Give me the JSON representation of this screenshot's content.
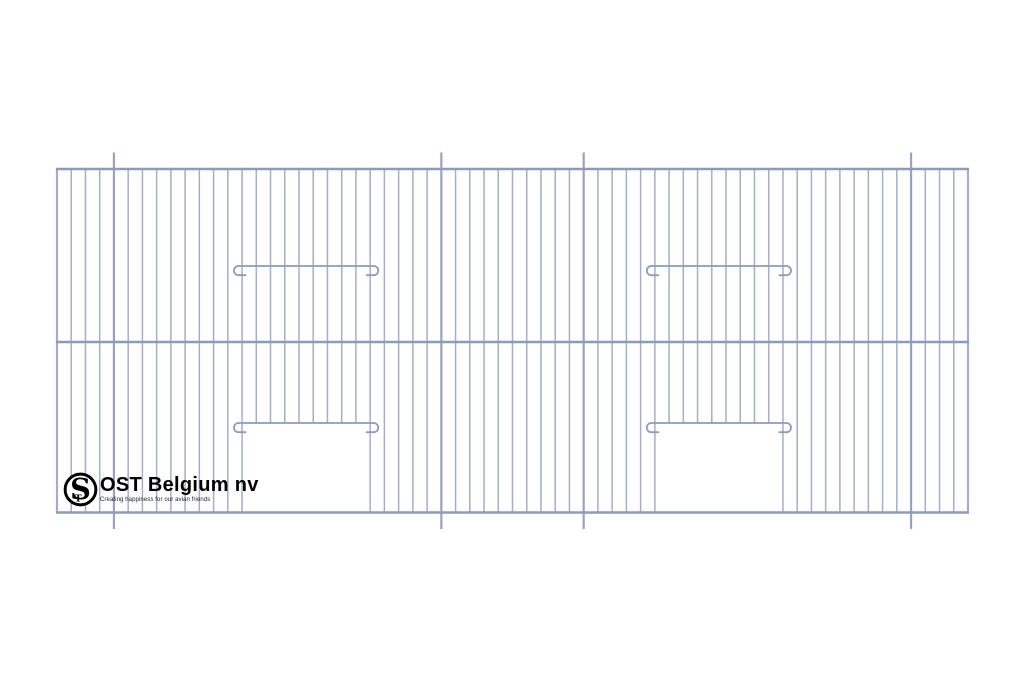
{
  "page": {
    "background_color": "#ffffff"
  },
  "drawing": {
    "title": "Bird cage front panel wire-grid technical drawing",
    "colors": {
      "wire": "#a3afc7",
      "frame": "#8c9bb8",
      "post": "#97a4bf",
      "hook": "#8c9bb8"
    },
    "panel": {
      "left": 57,
      "right": 968,
      "top": 169,
      "mid_rail": 342,
      "bottom": 512.5
    },
    "wire_count": 65,
    "post_indices": [
      4,
      27,
      37,
      60
    ],
    "post_overhang": 16.5,
    "doors": [
      {
        "left_index": 13,
        "right_index": 22
      },
      {
        "left_index": 42,
        "right_index": 51
      }
    ],
    "upper_hook_bar_y": 266,
    "door_hook_bar_y": 423,
    "hook_radius": 4.6,
    "hook_tip_length": 7,
    "hook_bar_overshoot": 3.5,
    "stroke_widths": {
      "wire": 1.5,
      "edge": 2.2,
      "post": 2.2,
      "frame": 2.4,
      "hook": 1.8
    }
  },
  "logo": {
    "monogram_large": "S",
    "monogram_small": "T",
    "company_name": "OST Belgium nv",
    "tagline": "Creating happiness for our avian friends"
  }
}
